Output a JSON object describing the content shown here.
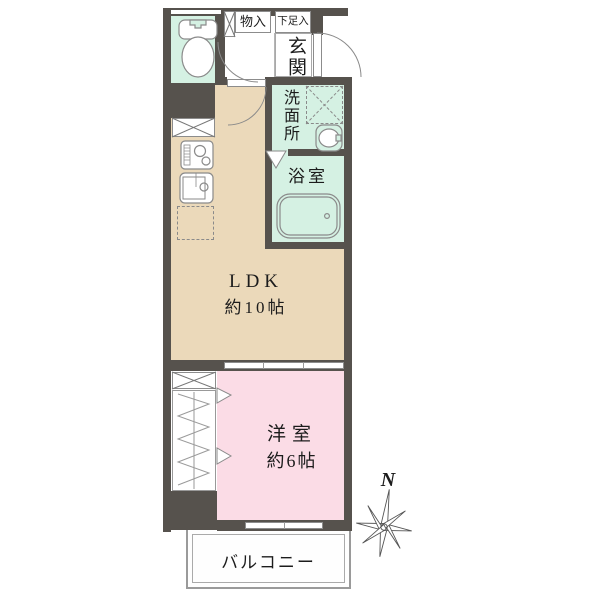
{
  "floorplan": {
    "type": "japanese-apartment-floorplan",
    "labels": {
      "entrance": "玄関",
      "storage": "物入",
      "shoe_cabinet": "下足入",
      "washroom": "洗面所",
      "bathroom": "浴室",
      "ldk_name": "LDK",
      "ldk_size": "約10帖",
      "western_room": "洋室",
      "western_room_size": "約6帖",
      "balcony": "バルコニー",
      "compass_north": "N"
    },
    "colors": {
      "wall": "#56524d",
      "wet_area_fill": "#d5f1e3",
      "ldk_fill": "#ebd9ba",
      "western_room_fill": "#fbdce6",
      "fixture_stroke": "#8a8a8a"
    },
    "rooms": [
      {
        "name": "LDK",
        "size": "約10帖"
      },
      {
        "name": "洋室",
        "size": "約6帖"
      },
      {
        "name": "玄関"
      },
      {
        "name": "洗面所"
      },
      {
        "name": "浴室"
      },
      {
        "name": "バルコニー"
      }
    ]
  }
}
